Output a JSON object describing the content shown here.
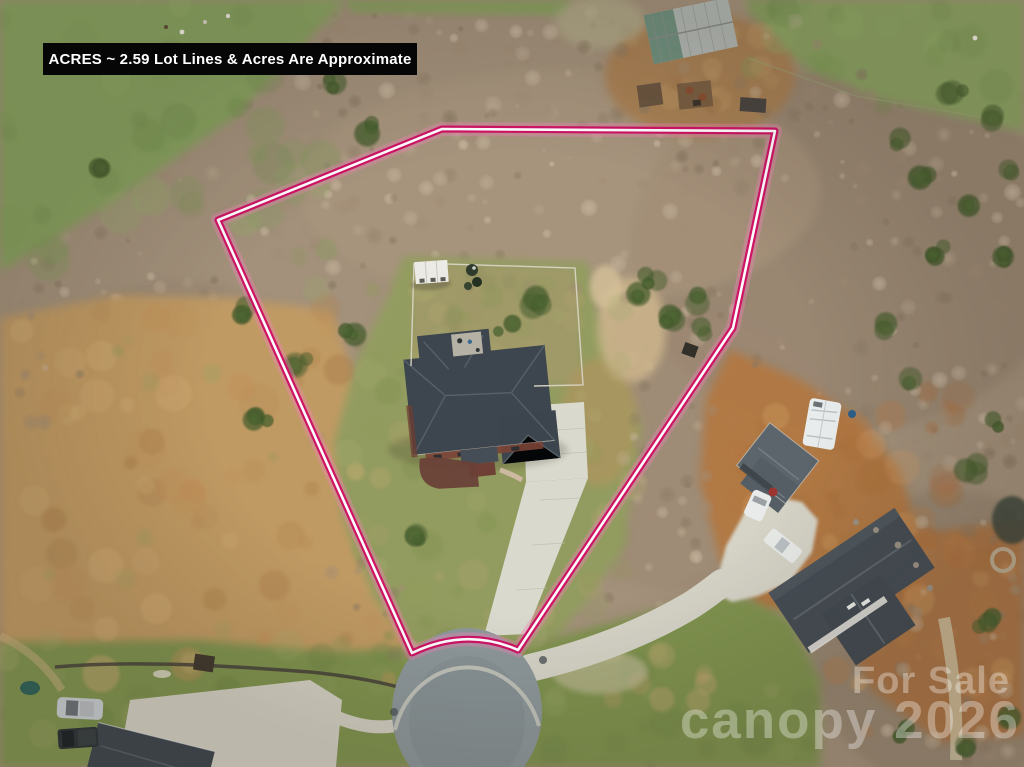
{
  "overlay": {
    "acreage_label": "ACRES ~ 2.59 Lot Lines & Acres Are Approximate",
    "label_bg": "#060606",
    "label_text_color": "#ffffff"
  },
  "watermark": {
    "line1": "For Sale",
    "line2": "canopy 2026",
    "color": "#ffffff",
    "opacity": 0.33
  },
  "lot_outline": {
    "stroke_color": "#cf1365",
    "core_color": "#ffffff",
    "glow_color": "#f084b5",
    "points": [
      [
        218,
        220
      ],
      [
        442,
        129
      ],
      [
        775,
        131
      ],
      [
        733,
        328
      ],
      [
        518,
        650
      ]
    ],
    "curve_control": [
      466,
      627
    ],
    "curve_end": [
      412,
      653
    ]
  },
  "scene": {
    "features": [
      "main-house",
      "driveway",
      "fenced-garden",
      "garden-shed",
      "cul-de-sac",
      "neighbor-house-east",
      "neighbor-house-southeast",
      "rv-camper",
      "barn",
      "pasture",
      "dirt-field",
      "winter-woods"
    ]
  }
}
